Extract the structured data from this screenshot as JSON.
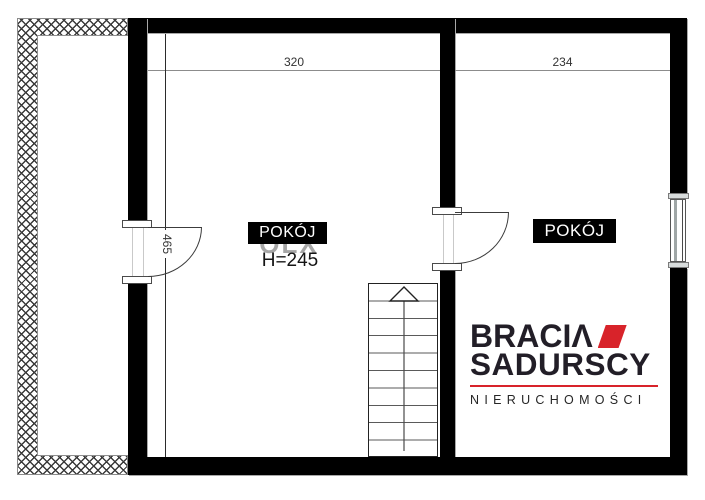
{
  "floorplan": {
    "dims": {
      "left_room_width": "320",
      "right_room_width": "234",
      "left_room_height": "465"
    },
    "left_room": {
      "label": "POKÓJ",
      "ceiling_height": "H=245"
    },
    "right_room": {
      "label": "POKÓJ"
    },
    "watermark": "OLX"
  },
  "logo": {
    "word1_main": "BRACI",
    "word1_accent": "Λ",
    "word2": "SADURSCY",
    "tagline": "NIERUCHOMOŚCI",
    "accent_color": "#d8232a",
    "text_color": "#221e27"
  }
}
